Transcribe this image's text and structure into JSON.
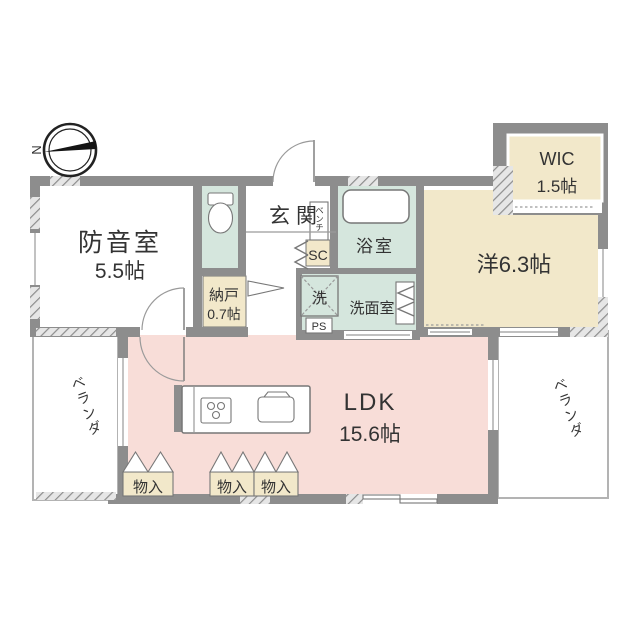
{
  "compass": {
    "north_label": "N"
  },
  "rooms": {
    "soundproof": {
      "name": "防音室",
      "size": "5.5帖"
    },
    "genkan": {
      "name": "玄関"
    },
    "bench": {
      "name": "ベンチ"
    },
    "shoe_closet": {
      "name": "SC"
    },
    "bath": {
      "name": "浴室"
    },
    "washer": {
      "name": "洗"
    },
    "washroom": {
      "name": "洗面室"
    },
    "pipe_space": {
      "name": "PS"
    },
    "storage_room": {
      "name": "納戸",
      "size": "0.7帖"
    },
    "western_room": {
      "name": "洋6.3帖"
    },
    "wic": {
      "name": "WIC",
      "size": "1.5帖"
    },
    "ldk": {
      "name": "LDK",
      "size": "15.6帖"
    },
    "veranda_left": {
      "name": "ベランダ"
    },
    "veranda_right": {
      "name": "ベランダ"
    },
    "storage1": {
      "name": "物入"
    },
    "storage2": {
      "name": "物入"
    },
    "storage3": {
      "name": "物入"
    }
  },
  "colors": {
    "wall": "#8d8d8d",
    "room_teal": "#d5e6dd",
    "room_beige": "#f2e8ca",
    "room_pink": "#f8ddd8",
    "fixture_line": "#777777",
    "veranda_line": "#b3b3b3",
    "text": "#333333",
    "needle": "#151515"
  }
}
